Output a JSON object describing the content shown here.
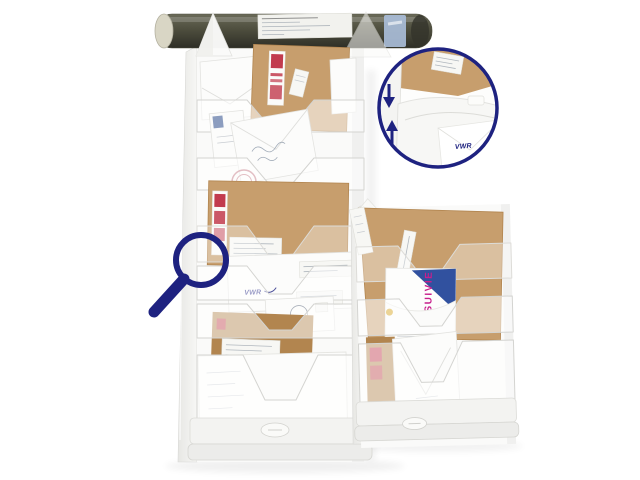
{
  "meta": {
    "type": "product-photo",
    "subject": "Wall-mounted multi-pocket literature and mail sorter racks filled with envelopes, with connection-detail zoom circle and magnifier icon",
    "background": "#ffffff"
  },
  "colors": {
    "navy": "#1e2280",
    "kraft": "#c79e6d",
    "kraft_shadow": "#b2854f",
    "rack_white": "#f6f6f4",
    "rack_edge": "#d9d9d6",
    "tube_olive": "#4e4e3e",
    "tube_cap": "#d9d6c5",
    "tube_band": "#a9bdd8",
    "stamp_red": "#c23b4e",
    "postmark_red": "#b2505e",
    "express_blue": "#31519f",
    "express_magenta": "#c71f8c",
    "seal_yellow": "#d4a017"
  },
  "labels": {
    "vwr_logo": "VWR",
    "vwr_logo_detail": "VWR",
    "express_text": "SUIVIE"
  },
  "icons": {
    "magnifier": "magnifying-glass-icon",
    "arrow_down": "down-arrow-icon",
    "arrow_up": "up-arrow-icon"
  }
}
